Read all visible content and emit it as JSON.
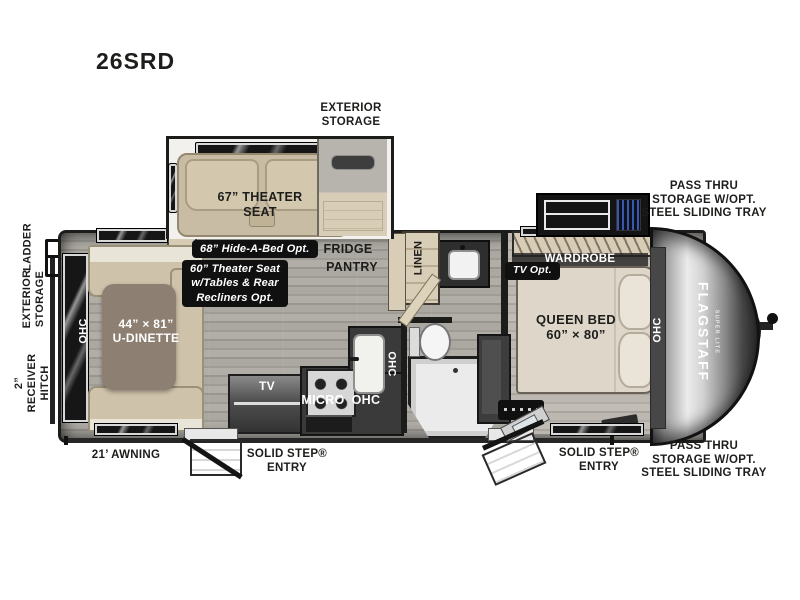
{
  "title": "26SRD",
  "colors": {
    "outline": "#1c1c1b",
    "floor": "#a5a29c",
    "bedroom_floor": "#b7b3ac",
    "cabinet_wood": "#d8cdb6",
    "upholstery_tan": "#c9bca4",
    "table_brown": "#8d7f71",
    "counter_dark": "#3a3a3a",
    "badge_bg": "#101010",
    "accent_blue": "#3a57b0"
  },
  "exterior": {
    "exterior_storage": "EXTERIOR\nSTORAGE",
    "pass_thru": "PASS THRU\nSTORAGE W/OPT.\nSTEEL SLIDING TRAY",
    "awning": "21’ AWNING",
    "solid_step": "SOLID STEP®\nENTRY",
    "ladder": "LADDER",
    "receiver_hitch": "2” RECEIVER\nHITCH"
  },
  "interior": {
    "theater_seat": "67” THEATER\nSEAT",
    "fridge": "FRIDGE",
    "pantry": "PANTRY",
    "linen": "LINEN",
    "wardrobe": "WARDROBE",
    "queen_bed": "QUEEN BED\n60” × 80”",
    "u_dinette": "44” × 81”\nU-DINETTE",
    "tv": "TV",
    "micro": "MICRO",
    "ohc": "OHC"
  },
  "badges": {
    "hide_a_bed": "68” Hide-A-Bed Opt.",
    "theater_opt": "60” Theater Seat\nw/Tables & Rear\nRecliners Opt.",
    "tv_opt": "TV Opt."
  },
  "brand": {
    "name": "FLAGSTAFF",
    "sub": "SUPER LITE"
  }
}
